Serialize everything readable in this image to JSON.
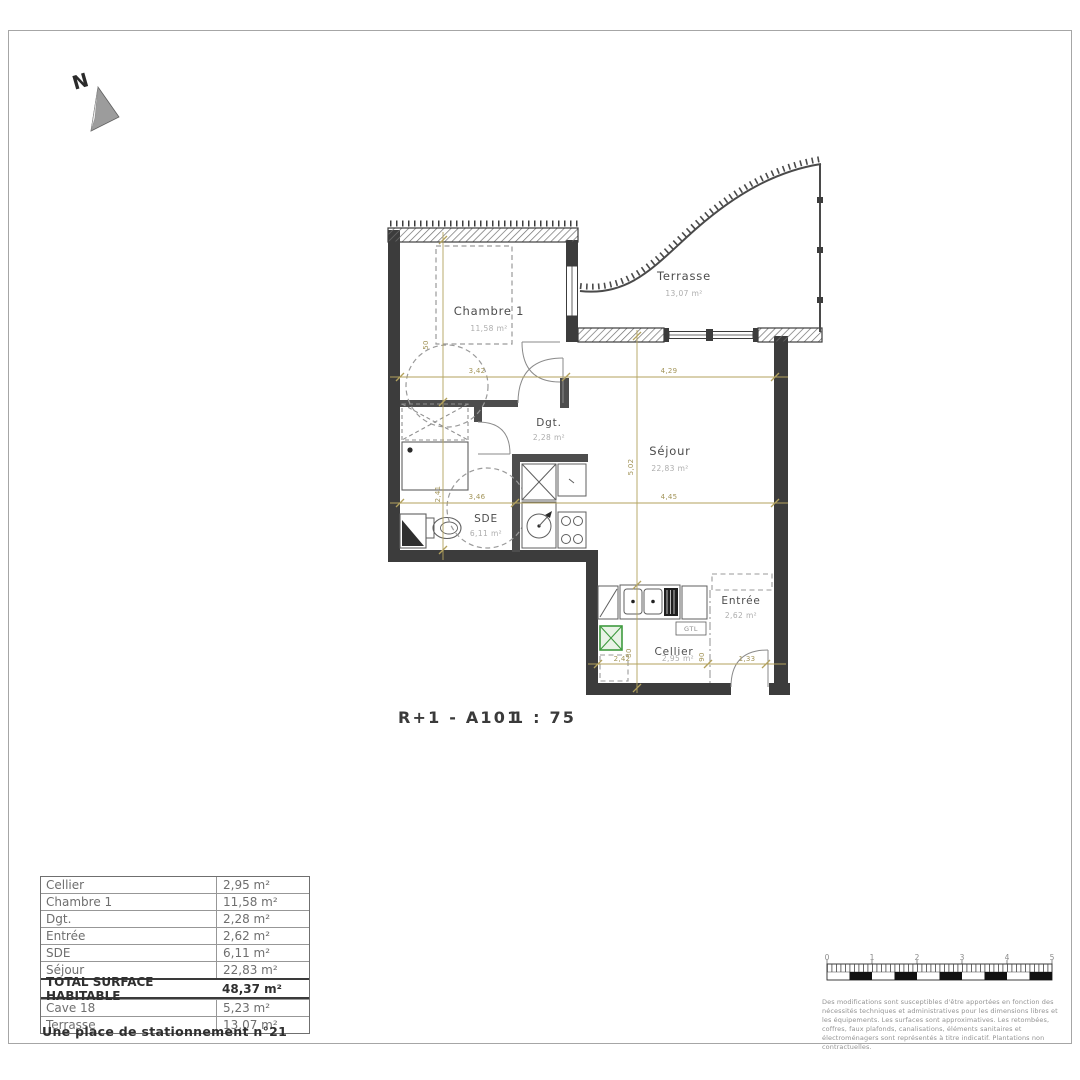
{
  "sheet": {
    "title": "R+1 - A101",
    "scale": "1 : 75",
    "north_label": "N"
  },
  "plan": {
    "rooms": {
      "chambre": {
        "name": "Chambre 1",
        "area": "11,58 m²"
      },
      "terrasse": {
        "name": "Terrasse",
        "area": "13,07 m²"
      },
      "dgt": {
        "name": "Dgt.",
        "area": "2,28 m²"
      },
      "sejour": {
        "name": "Séjour",
        "area": "22,83 m²"
      },
      "sde": {
        "name": "SDE",
        "area": "6,11 m²"
      },
      "entree": {
        "name": "Entrée",
        "area": "2,62 m²"
      },
      "cellier": {
        "name": "Cellier",
        "area": "2,95 m²"
      }
    },
    "labels": {
      "gtl": "GTL"
    },
    "dimensions": {
      "chambre_width": "3,42",
      "sejour_width_top": "4,29",
      "sde_width": "3,46",
      "sejour_width_mid": "4,45",
      "cellier_width": "2,42",
      "entree_width": "1,33",
      "sde_height": "2,41",
      "sejour_height": "5,02",
      "chambre_door": "50",
      "cellier_height": "30",
      "entree_height": "90"
    }
  },
  "surface_table": {
    "rows": [
      {
        "label": "Cellier",
        "value": "2,95 m²"
      },
      {
        "label": "Chambre 1",
        "value": "11,58 m²"
      },
      {
        "label": "Dgt.",
        "value": "2,28 m²"
      },
      {
        "label": "Entrée",
        "value": "2,62 m²"
      },
      {
        "label": "SDE",
        "value": "6,11 m²"
      },
      {
        "label": "Séjour",
        "value": "22,83 m²"
      }
    ],
    "total": {
      "label": "TOTAL SURFACE HABITABLE",
      "value": "48,37 m²"
    },
    "annex_rows": [
      {
        "label": "Cave 18",
        "value": "5,23 m²"
      },
      {
        "label": "Terrasse",
        "value": "13,07 m²"
      }
    ],
    "note": "Une place de stationnement n°21"
  },
  "scalebar": {
    "ticks": [
      "0",
      "1",
      "2",
      "3",
      "4",
      "5"
    ]
  },
  "disclaimer": {
    "text": "Des modifications sont susceptibles d'être apportées en fonction des nécessités techniques et administratives pour les dimensions libres et les équipements. Les surfaces sont approximatives. Les retombées, coffres, faux plafonds, canalisations, éléments sanitaires et électroménagers sont représentés à titre indicatif. Plantations non contractuelles."
  },
  "colors": {
    "wall": "#3c3c3c",
    "dimension": "#a3955a",
    "duct_green": "#3f9b3f",
    "text_gray": "#6e6e6e"
  }
}
